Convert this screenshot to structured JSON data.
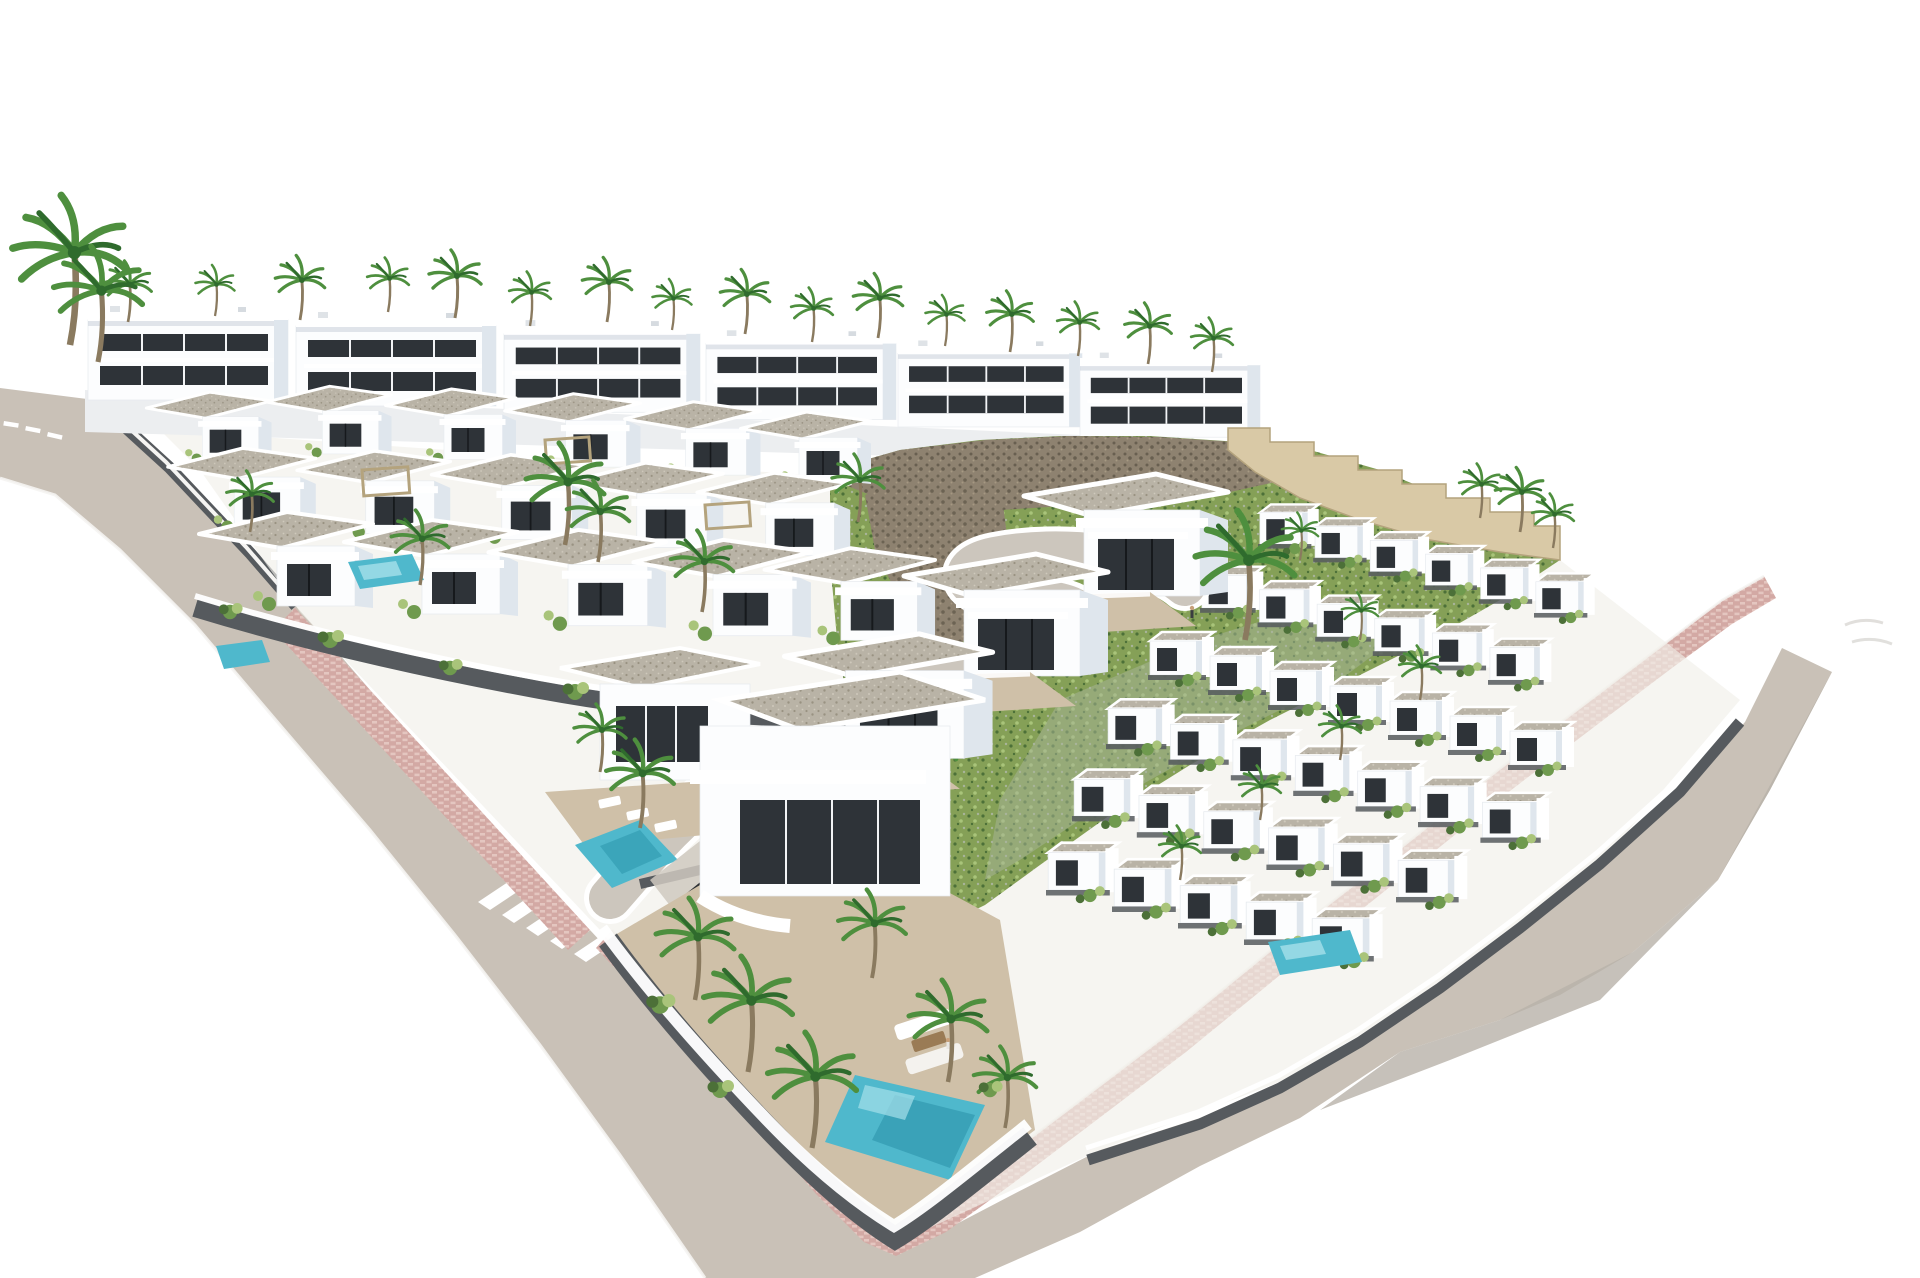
{
  "scene": {
    "type": "3d-architectural-aerial-render",
    "subject": "Aerial render of a hillside residential development of white modern villas and terraced houses with pools, palm trees, pink paved sidewalks and curved grey streets, isolated on a white background",
    "view": "high three-quarter aerial view",
    "background_note": "scene floats on pure white, site edges cut off"
  },
  "palette": {
    "bg": "#ffffff",
    "road": "#c9c1b7",
    "roadFar": "#b8b1a9",
    "streetInner": "#ccc6bd",
    "sidewalk": "#d3a9a4",
    "sidewalkLight": "#e4c6c0",
    "curb": "#f5f4f2",
    "laneMark": "#ffffff",
    "bldg": "#fcfdfe",
    "bldgEdge": "#e6eaee",
    "bldgShade": "#dfe6ed",
    "bldgShade2": "#c9d3dd",
    "parapetShadow": "#c3ccd6",
    "glass": "#2e3338",
    "glassFrame": "#16191c",
    "gravel": "#b9b3a6",
    "gravelDot": "#999282",
    "terraceFloor": "#cfc0a8",
    "wallDark": "#565a5e",
    "wallDarker": "#41454a",
    "fence": "#ffffff",
    "green": "#6f9a4e",
    "greenLight": "#a9c47a",
    "greenDark": "#4c7038",
    "sage": "#a8b49a",
    "hill": "#85a057",
    "rock": "#8e8270",
    "rockDark": "#685f50",
    "stepWall": "#d9c9a6",
    "stepWallShade": "#b4a37d",
    "palm": "#4e8f3e",
    "palmDark": "#2f6b2d",
    "trunk": "#8a7a5f",
    "pool": "#4fb8cc",
    "poolDeep": "#2f97ae",
    "poolLight": "#a5e0ea",
    "carDark": "#2c2f33",
    "carWhite": "#e9eceb",
    "groundTint": "#f1efe9",
    "rowBase": "#eceef0"
  },
  "inventory": {
    "back_apartment_blocks": 6,
    "mid_villa_units": 16,
    "terraced_row_units": 37,
    "foreground_villas": 5,
    "swimming_pools": 5,
    "palm_trees": 46,
    "crosswalk_stripes": 5,
    "lane_dashes": 3,
    "vehicles": [
      {
        "type": "suv",
        "color_name": "dark-grey"
      },
      {
        "type": "suv",
        "color_name": "white"
      }
    ],
    "roads": [
      "upper-left entry road",
      "main descending street",
      "lower-right boulevard",
      "internal loop street"
    ],
    "hillside": {
      "cover": "green scrub with rock outcrops",
      "boundary": "stepped sandstone wall"
    },
    "sidewalk_finish": "pink brick pavers"
  }
}
